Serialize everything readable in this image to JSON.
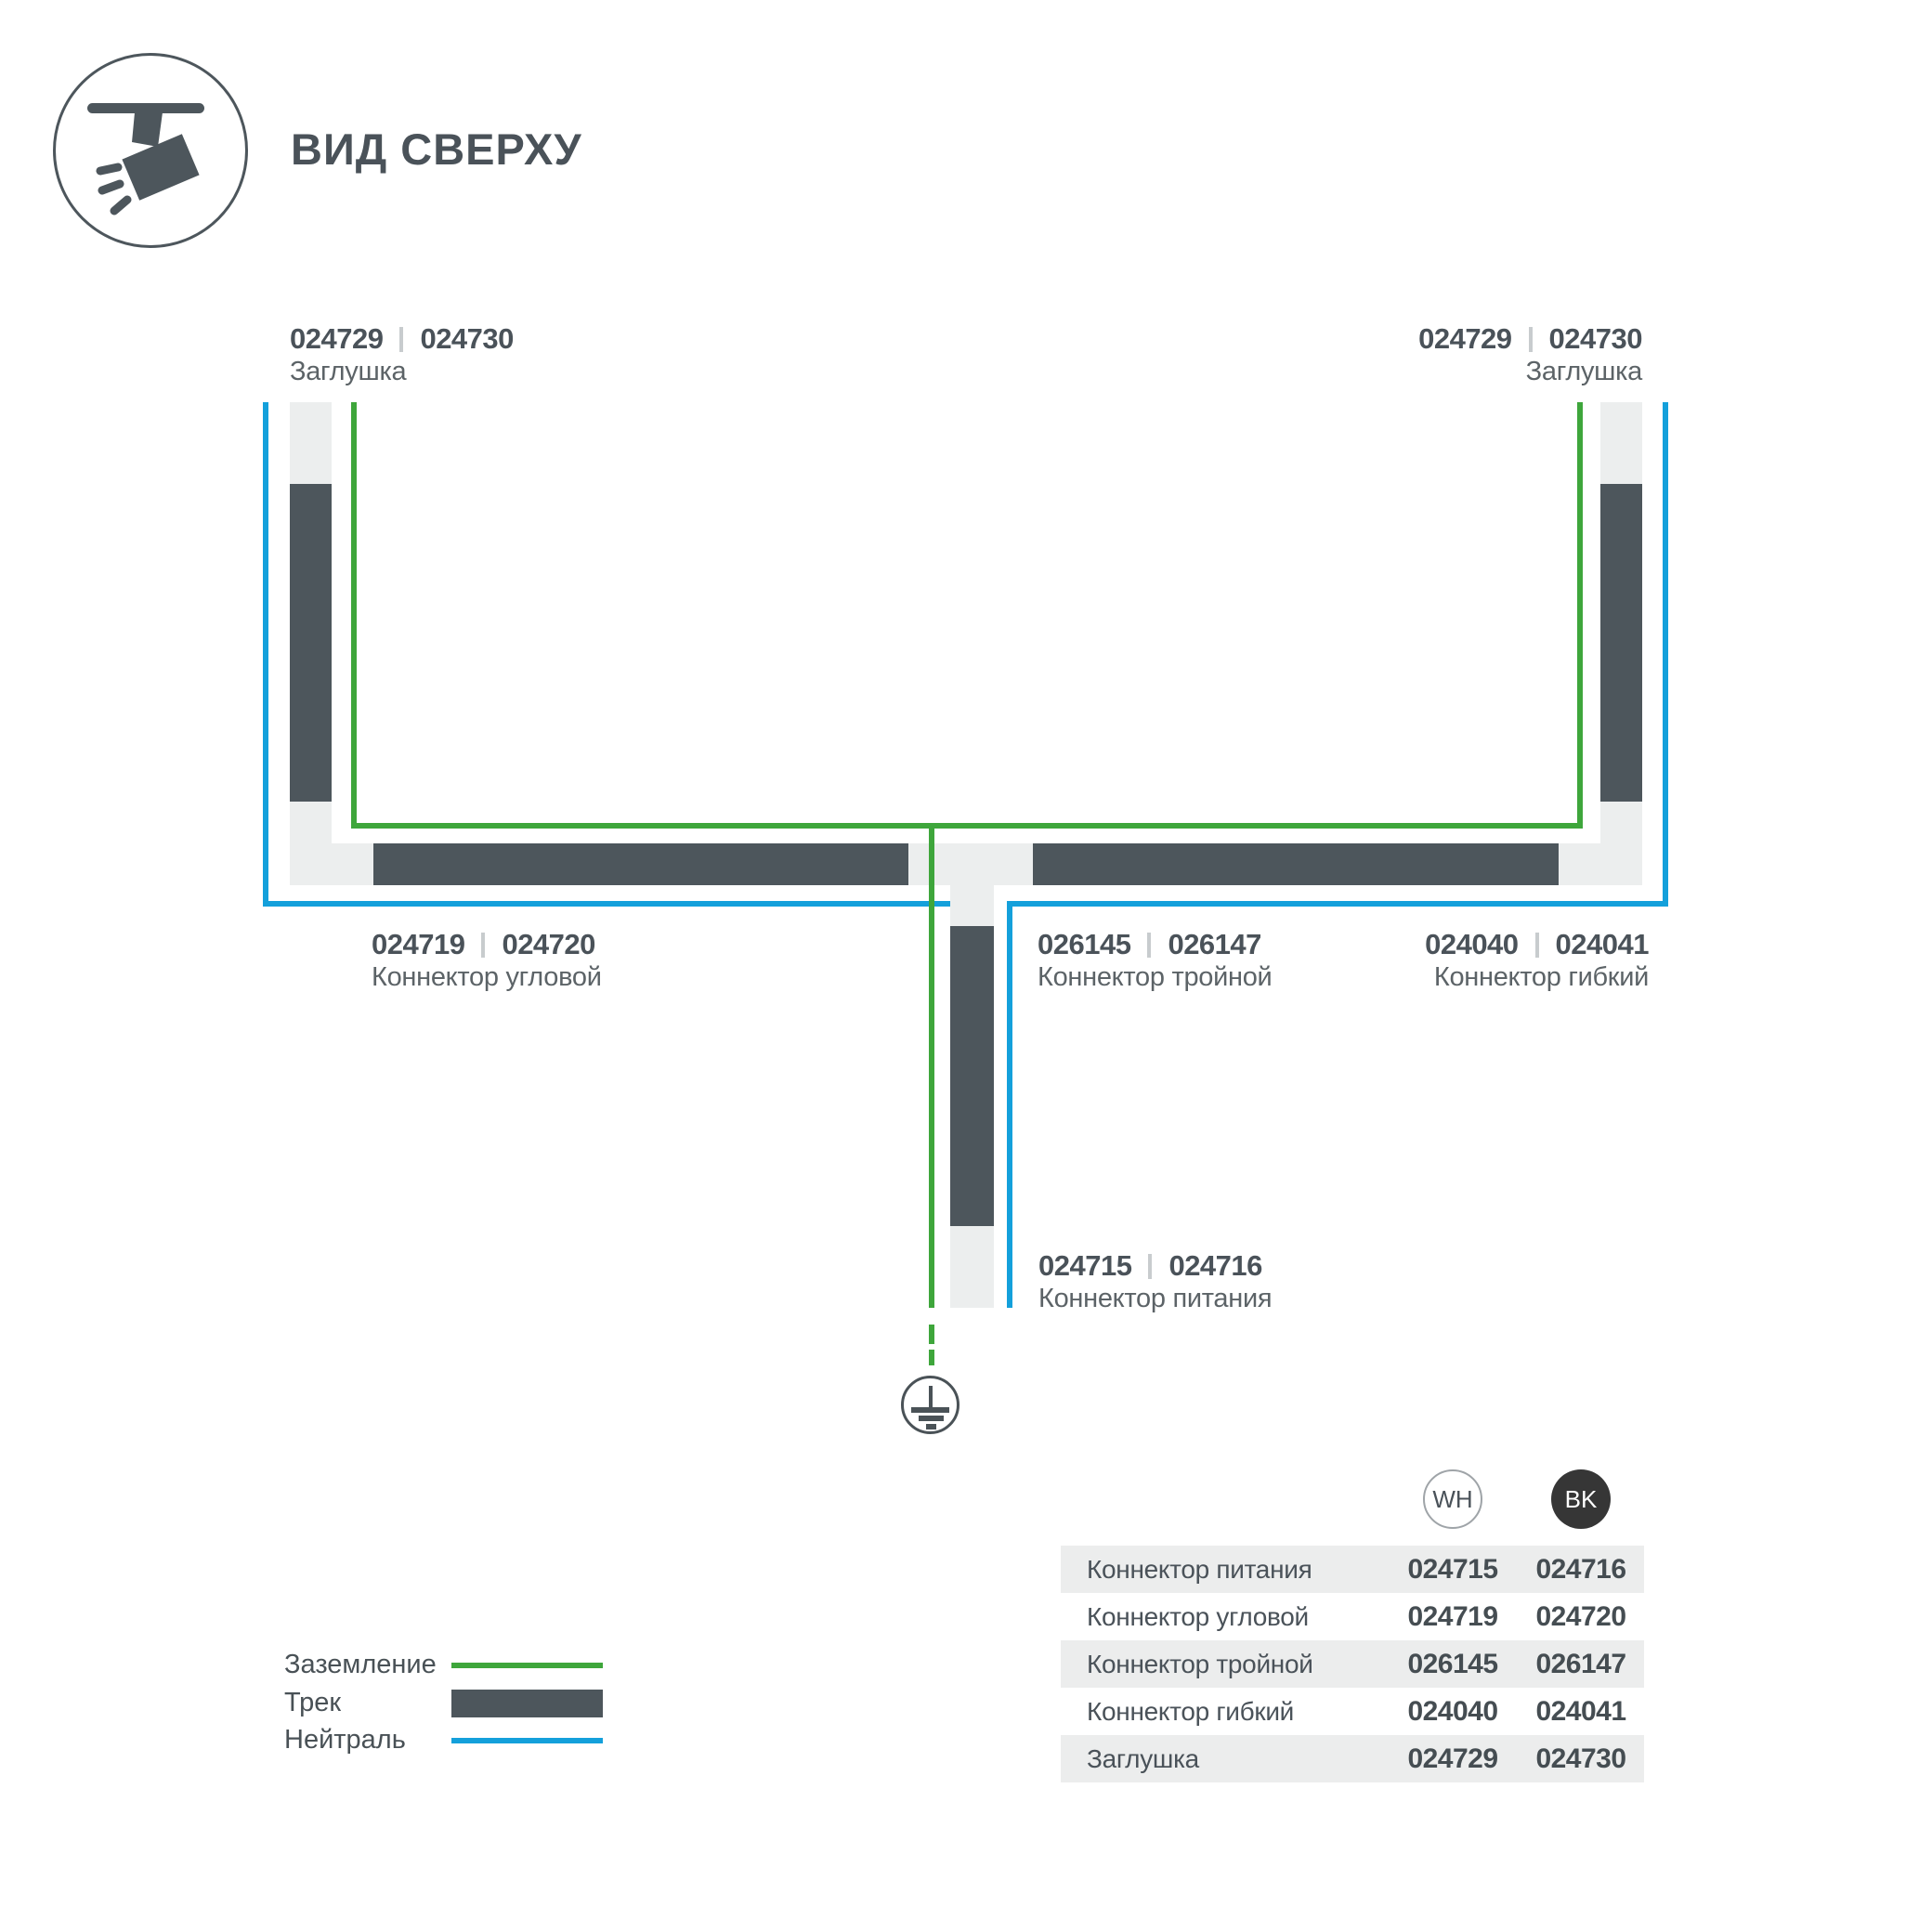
{
  "header": {
    "title": "ВИД СВЕРХУ"
  },
  "colors": {
    "ground_green": "#3EA63B",
    "neutral_blue": "#14A0DB",
    "track_dark": "#4D565C",
    "connector_light": "#ECEEEE",
    "table_row_gray": "#ECEDED",
    "bk_badge": "#363636"
  },
  "diagram": {
    "endcap_left": {
      "wh": "024729",
      "bk": "024730",
      "name": "Заглушка"
    },
    "endcap_right": {
      "wh": "024729",
      "bk": "024730",
      "name": "Заглушка"
    },
    "corner": {
      "wh": "024719",
      "bk": "024720",
      "name": "Коннектор угловой"
    },
    "triple": {
      "wh": "026145",
      "bk": "026147",
      "name": "Коннектор тройной"
    },
    "flex": {
      "wh": "024040",
      "bk": "024041",
      "name": "Коннектор гибкий"
    },
    "power": {
      "wh": "024715",
      "bk": "024716",
      "name": "Коннектор питания"
    }
  },
  "legend": {
    "items": [
      {
        "label": "Заземление",
        "type": "ground-line"
      },
      {
        "label": "Трек",
        "type": "track-bar"
      },
      {
        "label": "Нейтраль",
        "type": "neutral-line"
      }
    ]
  },
  "table": {
    "header": {
      "wh": "WH",
      "bk": "BK"
    },
    "rows": [
      {
        "name": "Коннектор питания",
        "wh": "024715",
        "bk": "024716"
      },
      {
        "name": "Коннектор угловой",
        "wh": "024719",
        "bk": "024720"
      },
      {
        "name": "Коннектор тройной",
        "wh": "026145",
        "bk": "026147"
      },
      {
        "name": "Коннектор гибкий",
        "wh": "024040",
        "bk": "024041"
      },
      {
        "name": "Заглушка",
        "wh": "024729",
        "bk": "024730"
      }
    ]
  }
}
